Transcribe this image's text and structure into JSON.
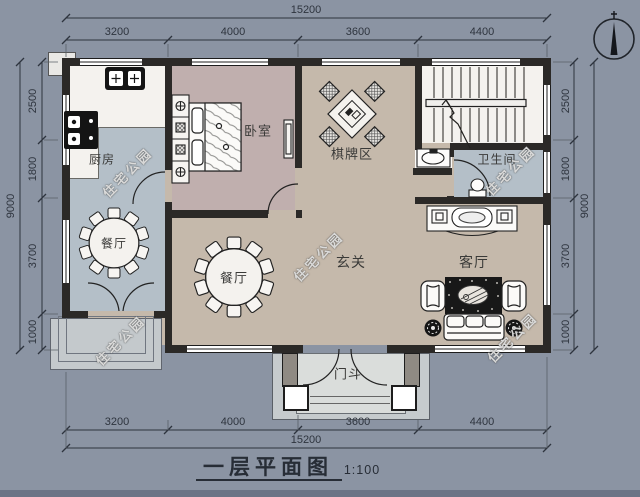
{
  "title_block": {
    "title": "一层平面图",
    "scale": "1:100"
  },
  "watermark": {
    "text": "住宅公园"
  },
  "dimensions": {
    "horizontal": {
      "total": "15200",
      "segments": [
        "3200",
        "4000",
        "3600",
        "4400"
      ]
    },
    "vertical": {
      "total": "9000",
      "segments": [
        "2500",
        "1800",
        "3700",
        "1000"
      ]
    }
  },
  "rooms": {
    "kitchen": "厨房",
    "bedroom": "卧室",
    "game_area": "棋牌区",
    "bathroom": "卫生间",
    "dining1": "餐厅",
    "dining2": "餐厅",
    "foyer": "玄关",
    "living": "客厅",
    "vestibule": "门斗"
  },
  "colors": {
    "background": "#8b94a3",
    "floor_hall": "#c5b9ab",
    "floor_bedroom": "#c0afae",
    "floor_bluegray": "#b4bfc8",
    "floor_white": "#f4f2ee",
    "wall": "#2b2927",
    "dim_line": "#2e343e"
  }
}
